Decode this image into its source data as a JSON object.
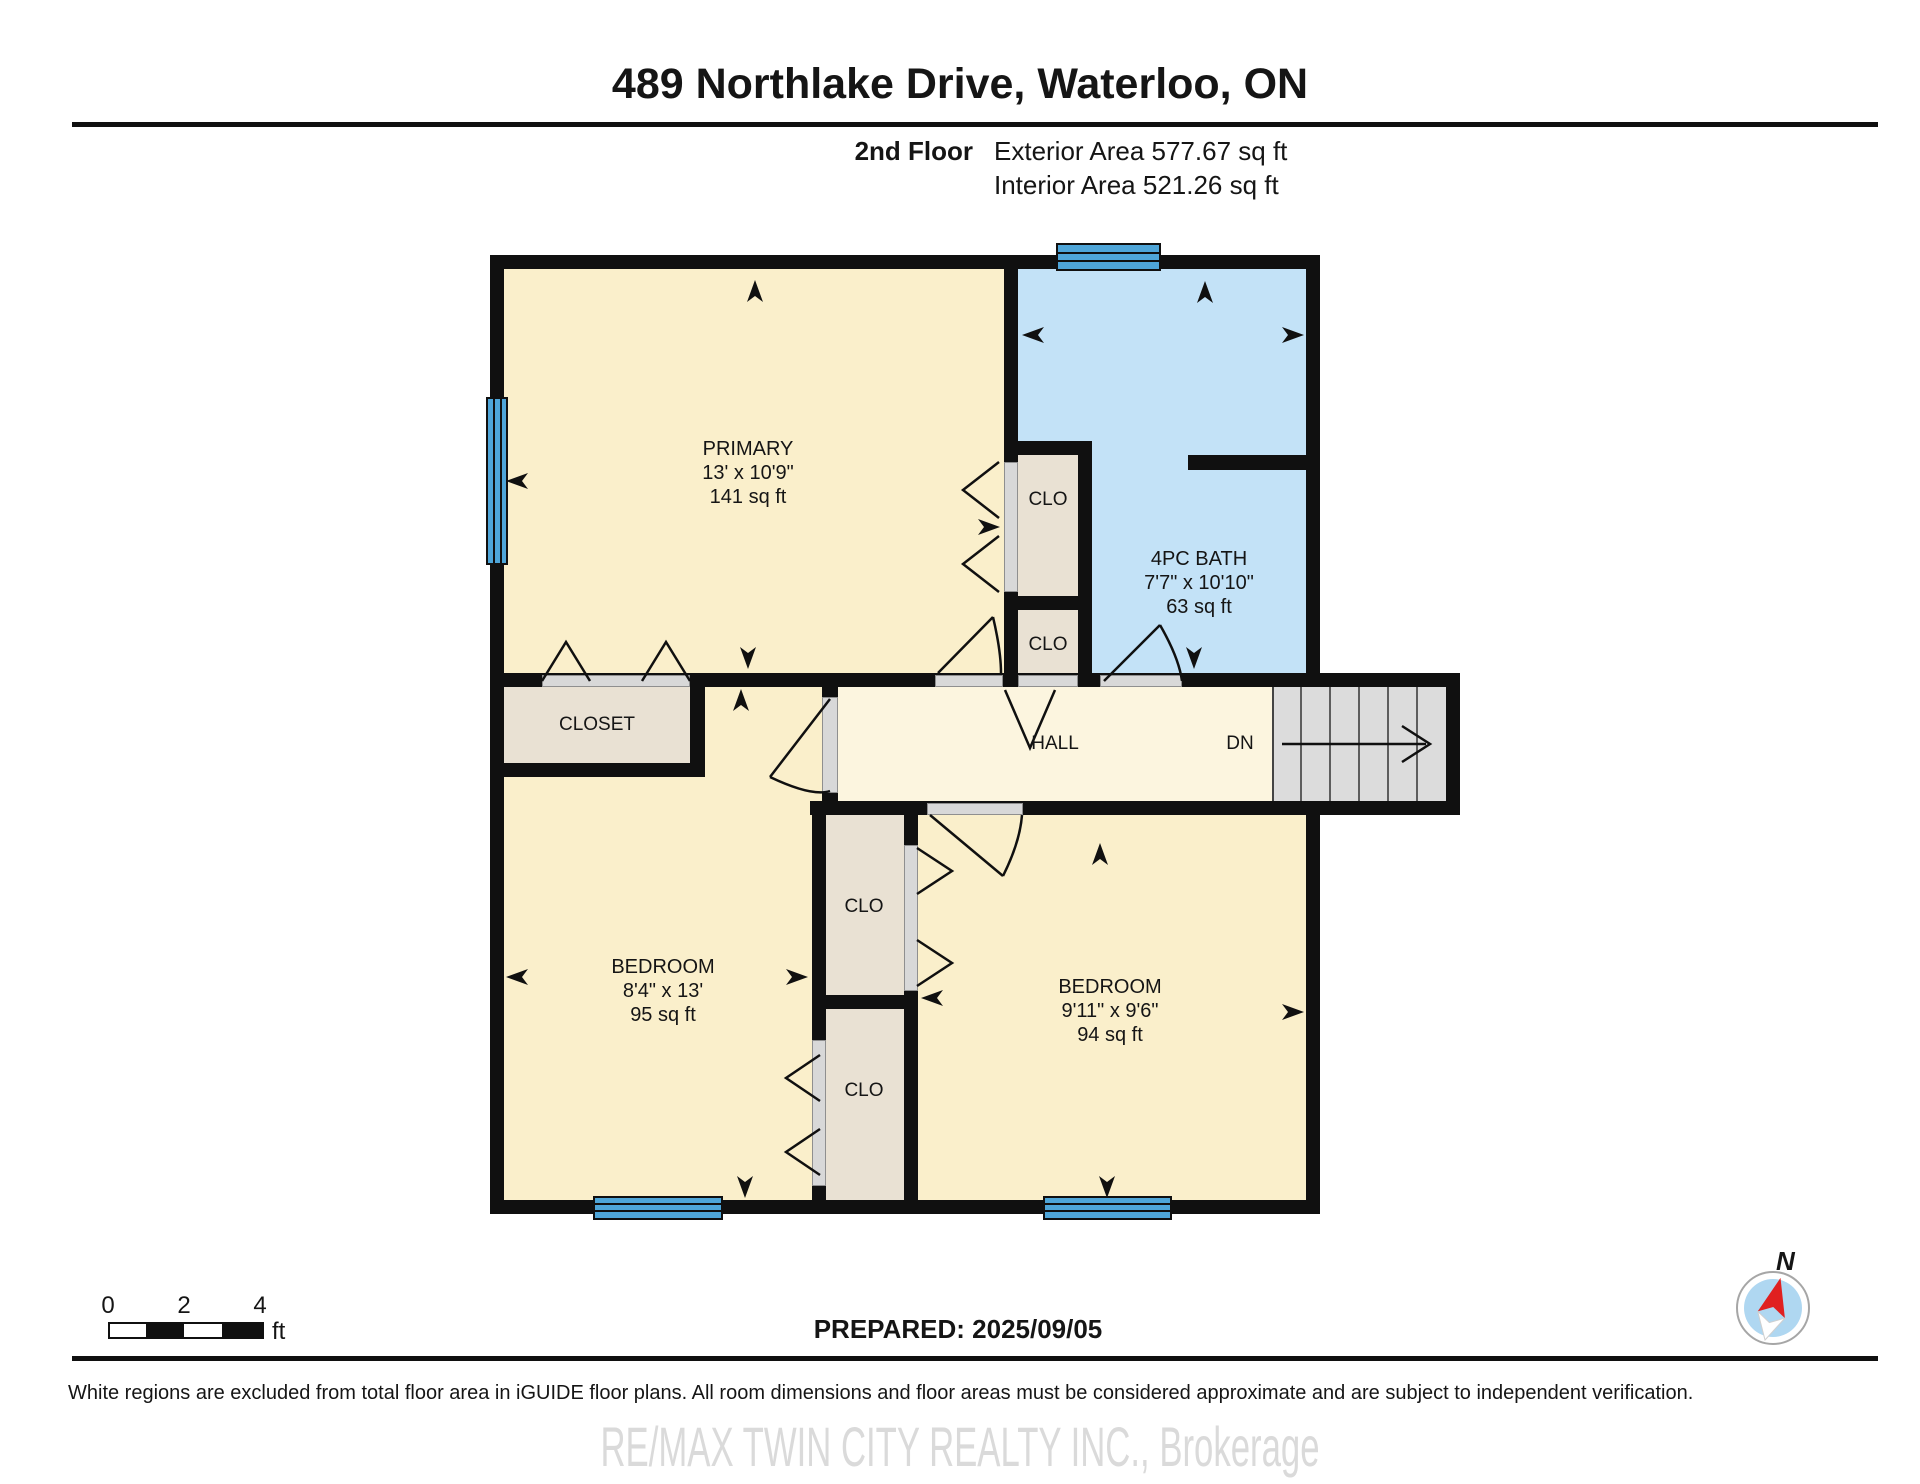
{
  "header": {
    "title": "489 Northlake Drive, Waterloo, ON",
    "floor_label": "2nd Floor",
    "exterior_area": "Exterior Area 577.67 sq ft",
    "interior_area": "Interior Area 521.26 sq ft"
  },
  "rooms": {
    "primary": {
      "name": "PRIMARY",
      "dims": "13' x 10'9\"",
      "area": "141 sq ft"
    },
    "bath": {
      "name": "4PC BATH",
      "dims": "7'7\" x 10'10\"",
      "area": "63 sq ft"
    },
    "bedroom_left": {
      "name": "BEDROOM",
      "dims": "8'4\" x 13'",
      "area": "95 sq ft"
    },
    "bedroom_right": {
      "name": "BEDROOM",
      "dims": "9'11\" x 9'6\"",
      "area": "94 sq ft"
    },
    "hall": "HALL",
    "closet": "CLOSET",
    "clo": "CLO",
    "stairs_down": "DN"
  },
  "footer": {
    "scale": {
      "zero": "0",
      "two": "2",
      "four": "4",
      "unit": "ft"
    },
    "prepared": "PREPARED: 2025/09/05",
    "compass": "N",
    "disclaimer": "White regions are excluded from total floor area in iGUIDE floor plans. All room dimensions and floor areas must be considered approximate and are subject to independent verification.",
    "watermark": "RE/MAX TWIN CITY REALTY INC., Brokerage"
  },
  "colors": {
    "wall": "#101010",
    "room_cream": "#FAEFCB",
    "hall_cream": "#FCF5DF",
    "bath_blue": "#C3E2F7",
    "closet_beige": "#E9E1D3",
    "window_blue": "#4EA5D8",
    "stairs_gray": "#DCDCDC"
  }
}
